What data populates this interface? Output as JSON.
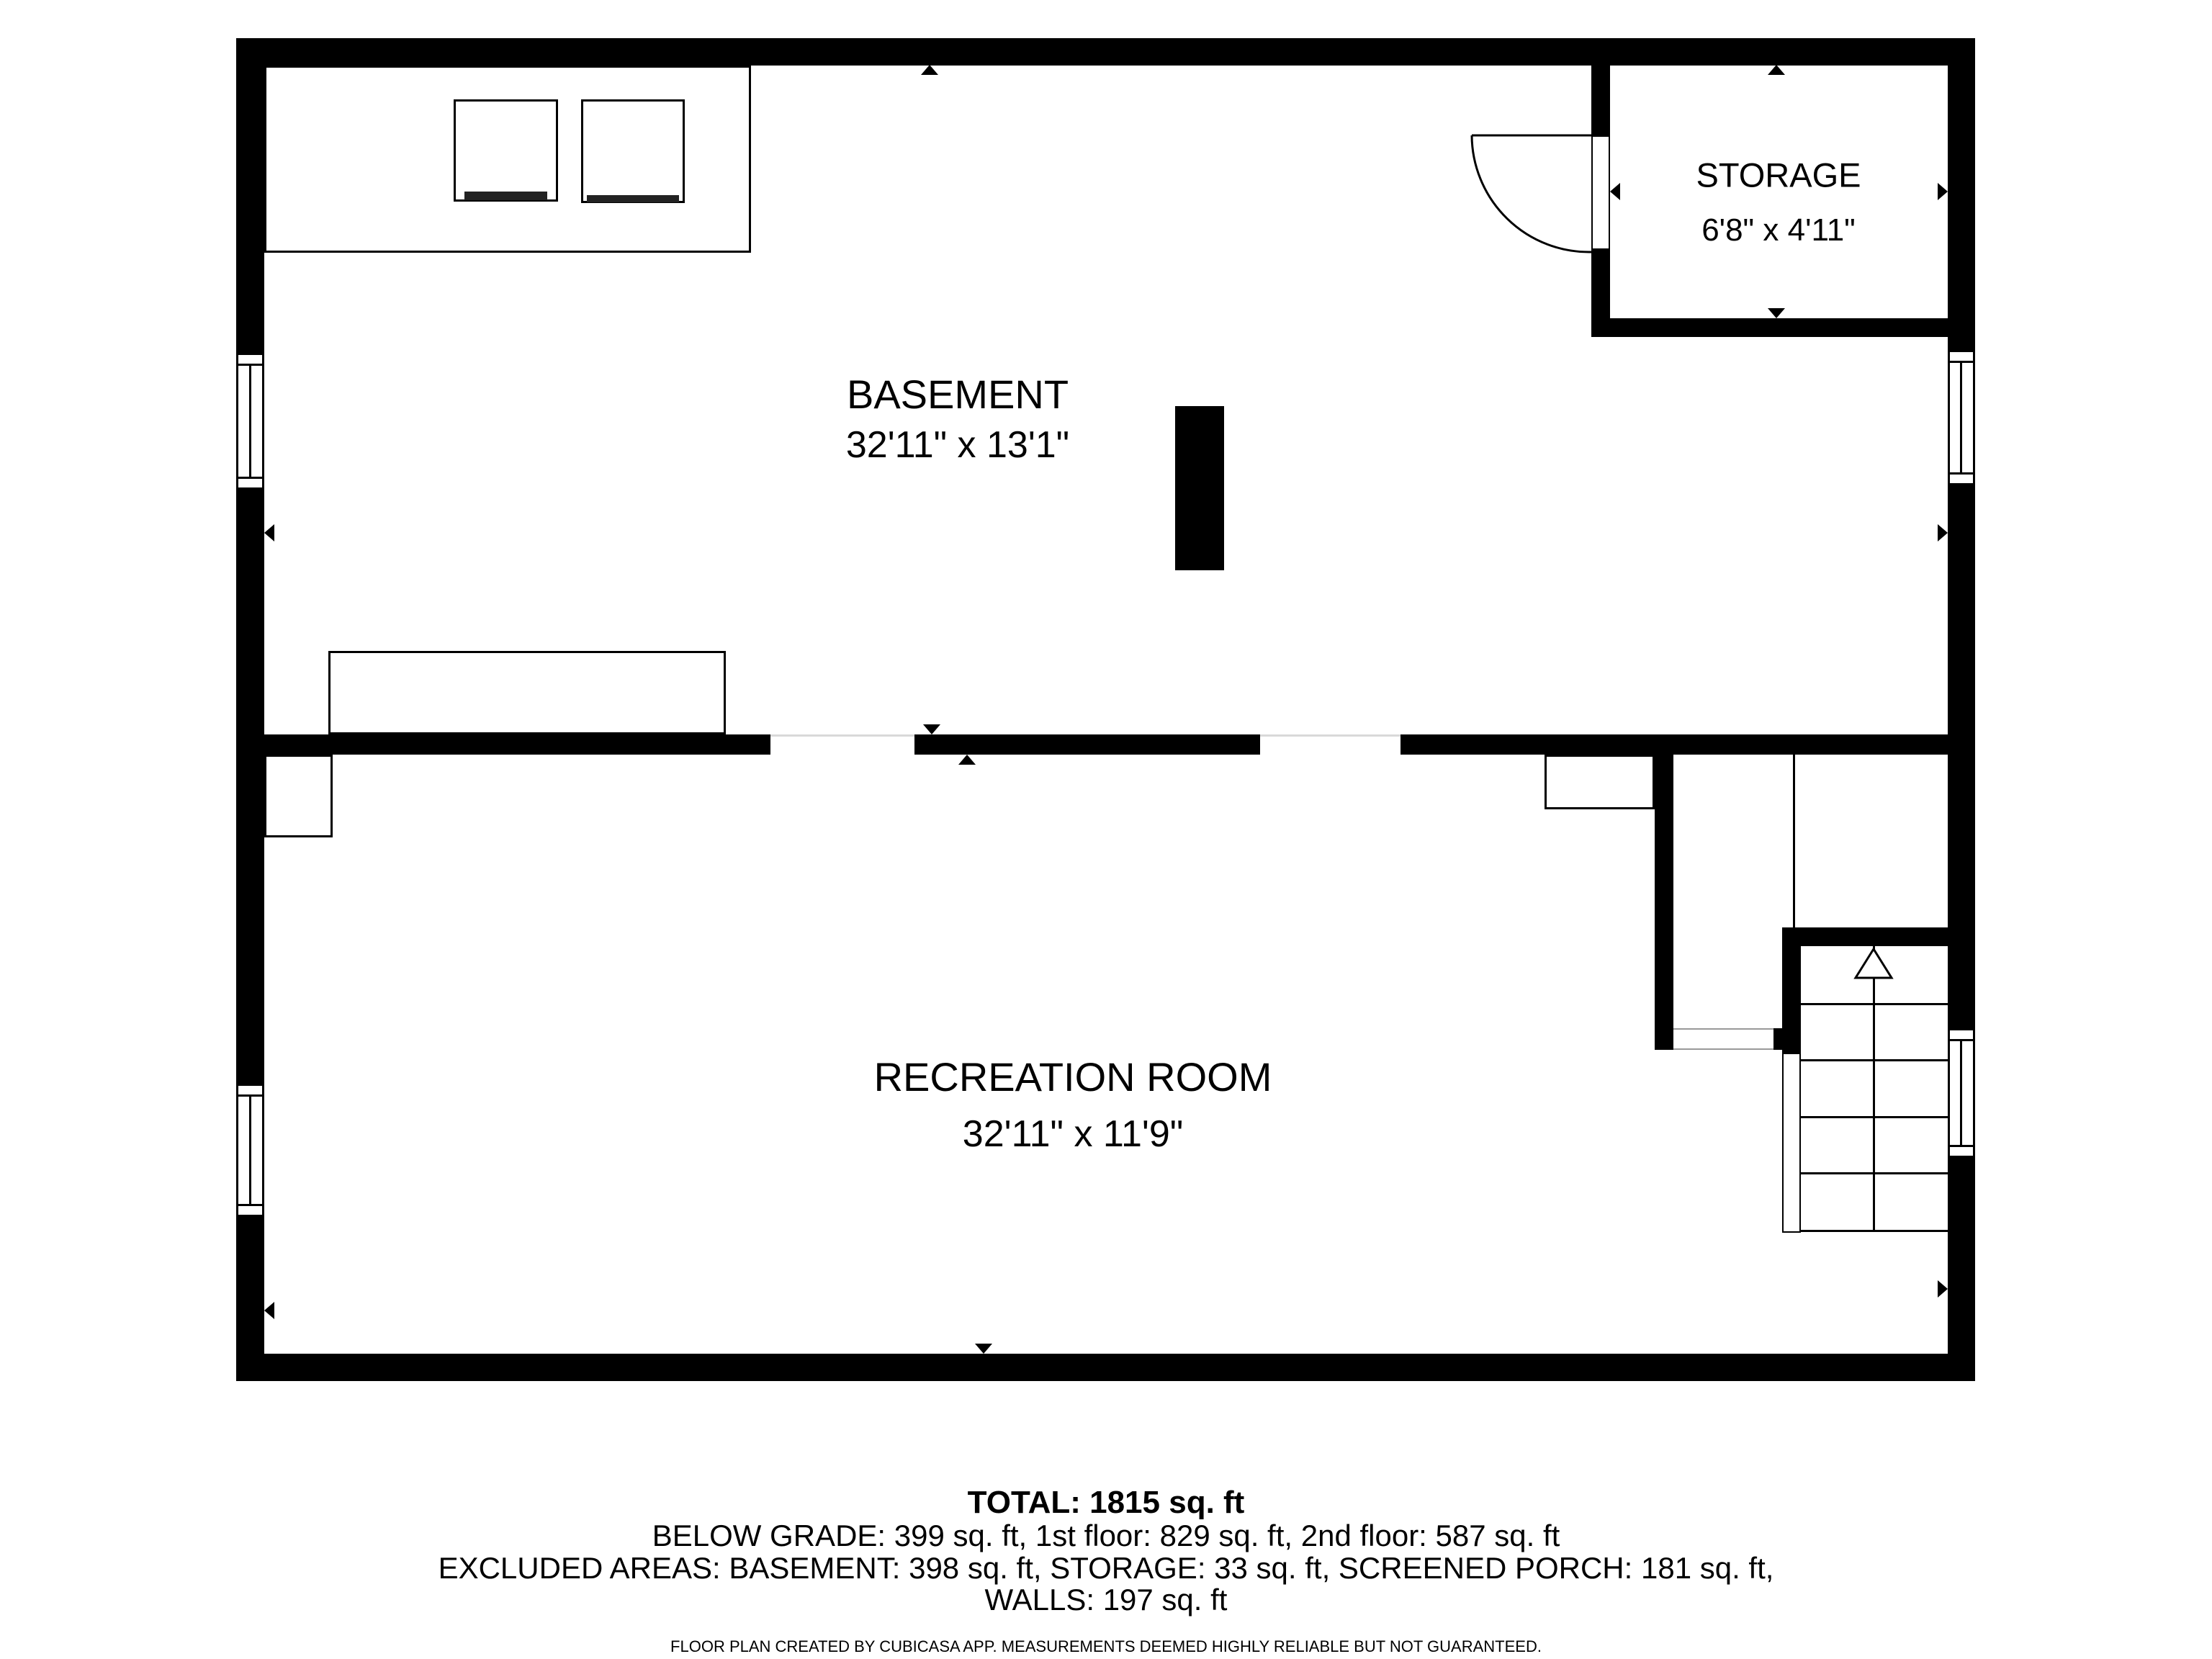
{
  "rooms": {
    "basement": {
      "label": "BASEMENT",
      "dims": "32'11\" x 13'1\""
    },
    "storage": {
      "label": "STORAGE",
      "dims": "6'8\" x 4'11\""
    },
    "recreation": {
      "label": "RECREATION ROOM",
      "dims": "32'11\" x 11'9\""
    }
  },
  "footer": {
    "total": "TOTAL: 1815 sq. ft",
    "areas": "BELOW GRADE: 399 sq. ft, 1st floor: 829 sq. ft, 2nd floor: 587 sq. ft",
    "excluded": "EXCLUDED AREAS: BASEMENT: 398 sq. ft, STORAGE: 33 sq. ft, SCREENED PORCH: 181 sq. ft,",
    "walls": "WALLS: 197 sq. ft",
    "disclaimer": "FLOOR PLAN CREATED BY CUBICASA APP. MEASUREMENTS DEEMED HIGHLY RELIABLE BUT NOT GUARANTEED."
  },
  "colors": {
    "wall": "#000000",
    "background": "#ffffff"
  }
}
